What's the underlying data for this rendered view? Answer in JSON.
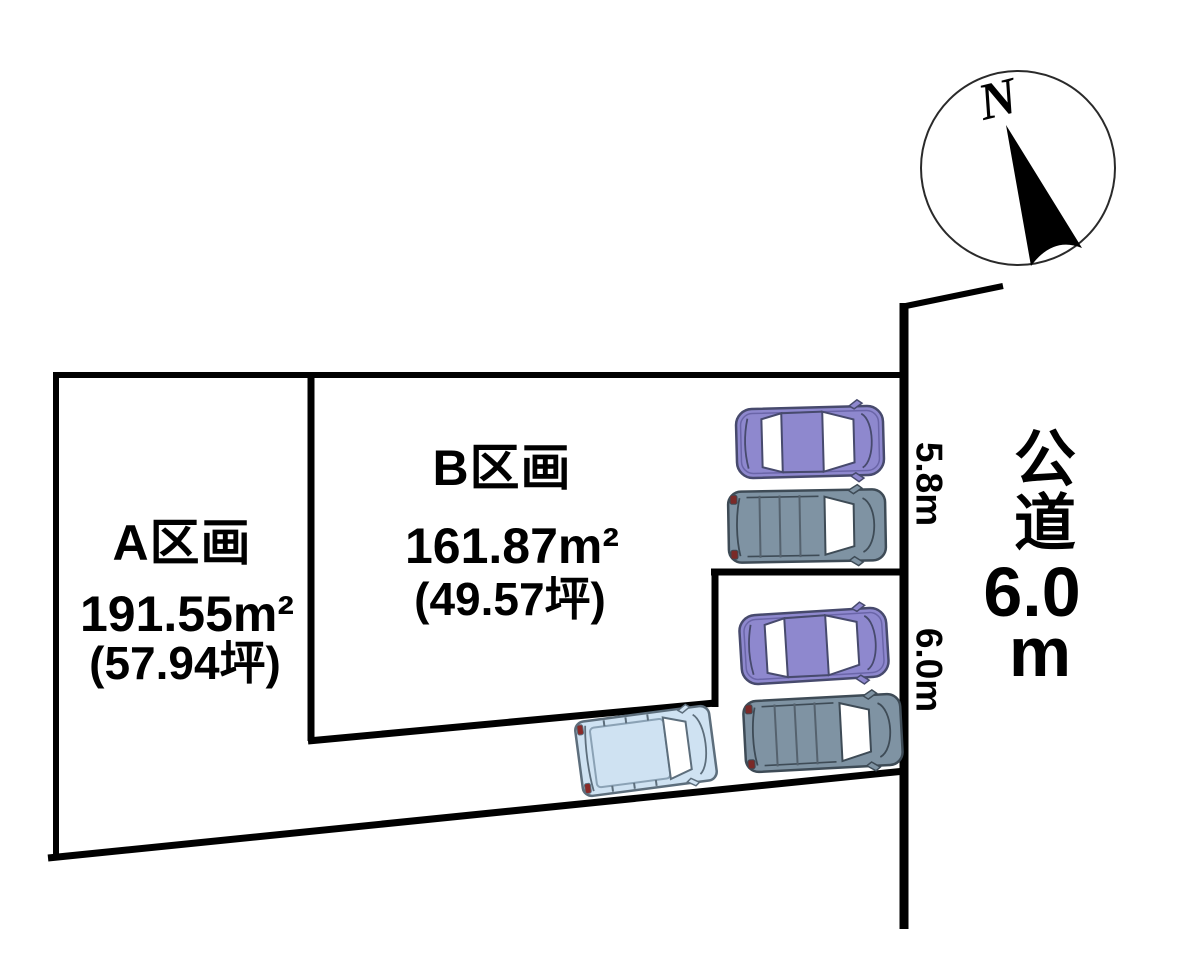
{
  "diagram": {
    "compass": {
      "north_label": "N"
    },
    "plots": [
      {
        "name": "A区画",
        "area_m2": "191.55m²",
        "area_tsubo": "(57.94坪)"
      },
      {
        "name": "B区画",
        "area_m2": "161.87m²",
        "area_tsubo": "(49.57坪)"
      }
    ],
    "frontages": {
      "upper": "5.8m",
      "lower": "6.0m"
    },
    "road": {
      "name": "公道",
      "width_value": "6.0",
      "width_unit": "m"
    },
    "cars": [
      {
        "type": "sedan",
        "color": "#8e88ce"
      },
      {
        "type": "suv",
        "color": "#7f93a3"
      },
      {
        "type": "sedan",
        "color": "#8e88ce"
      },
      {
        "type": "suv",
        "color": "#7f93a3"
      },
      {
        "type": "van",
        "color": "#cfe2f2"
      }
    ],
    "colors": {
      "boundary_line": "#000000",
      "background": "#ffffff",
      "sedan_body": "#8e88ce",
      "suv_body": "#7f93a3",
      "van_body": "#cfe2f2",
      "tail_light": "#7a2a28"
    }
  }
}
